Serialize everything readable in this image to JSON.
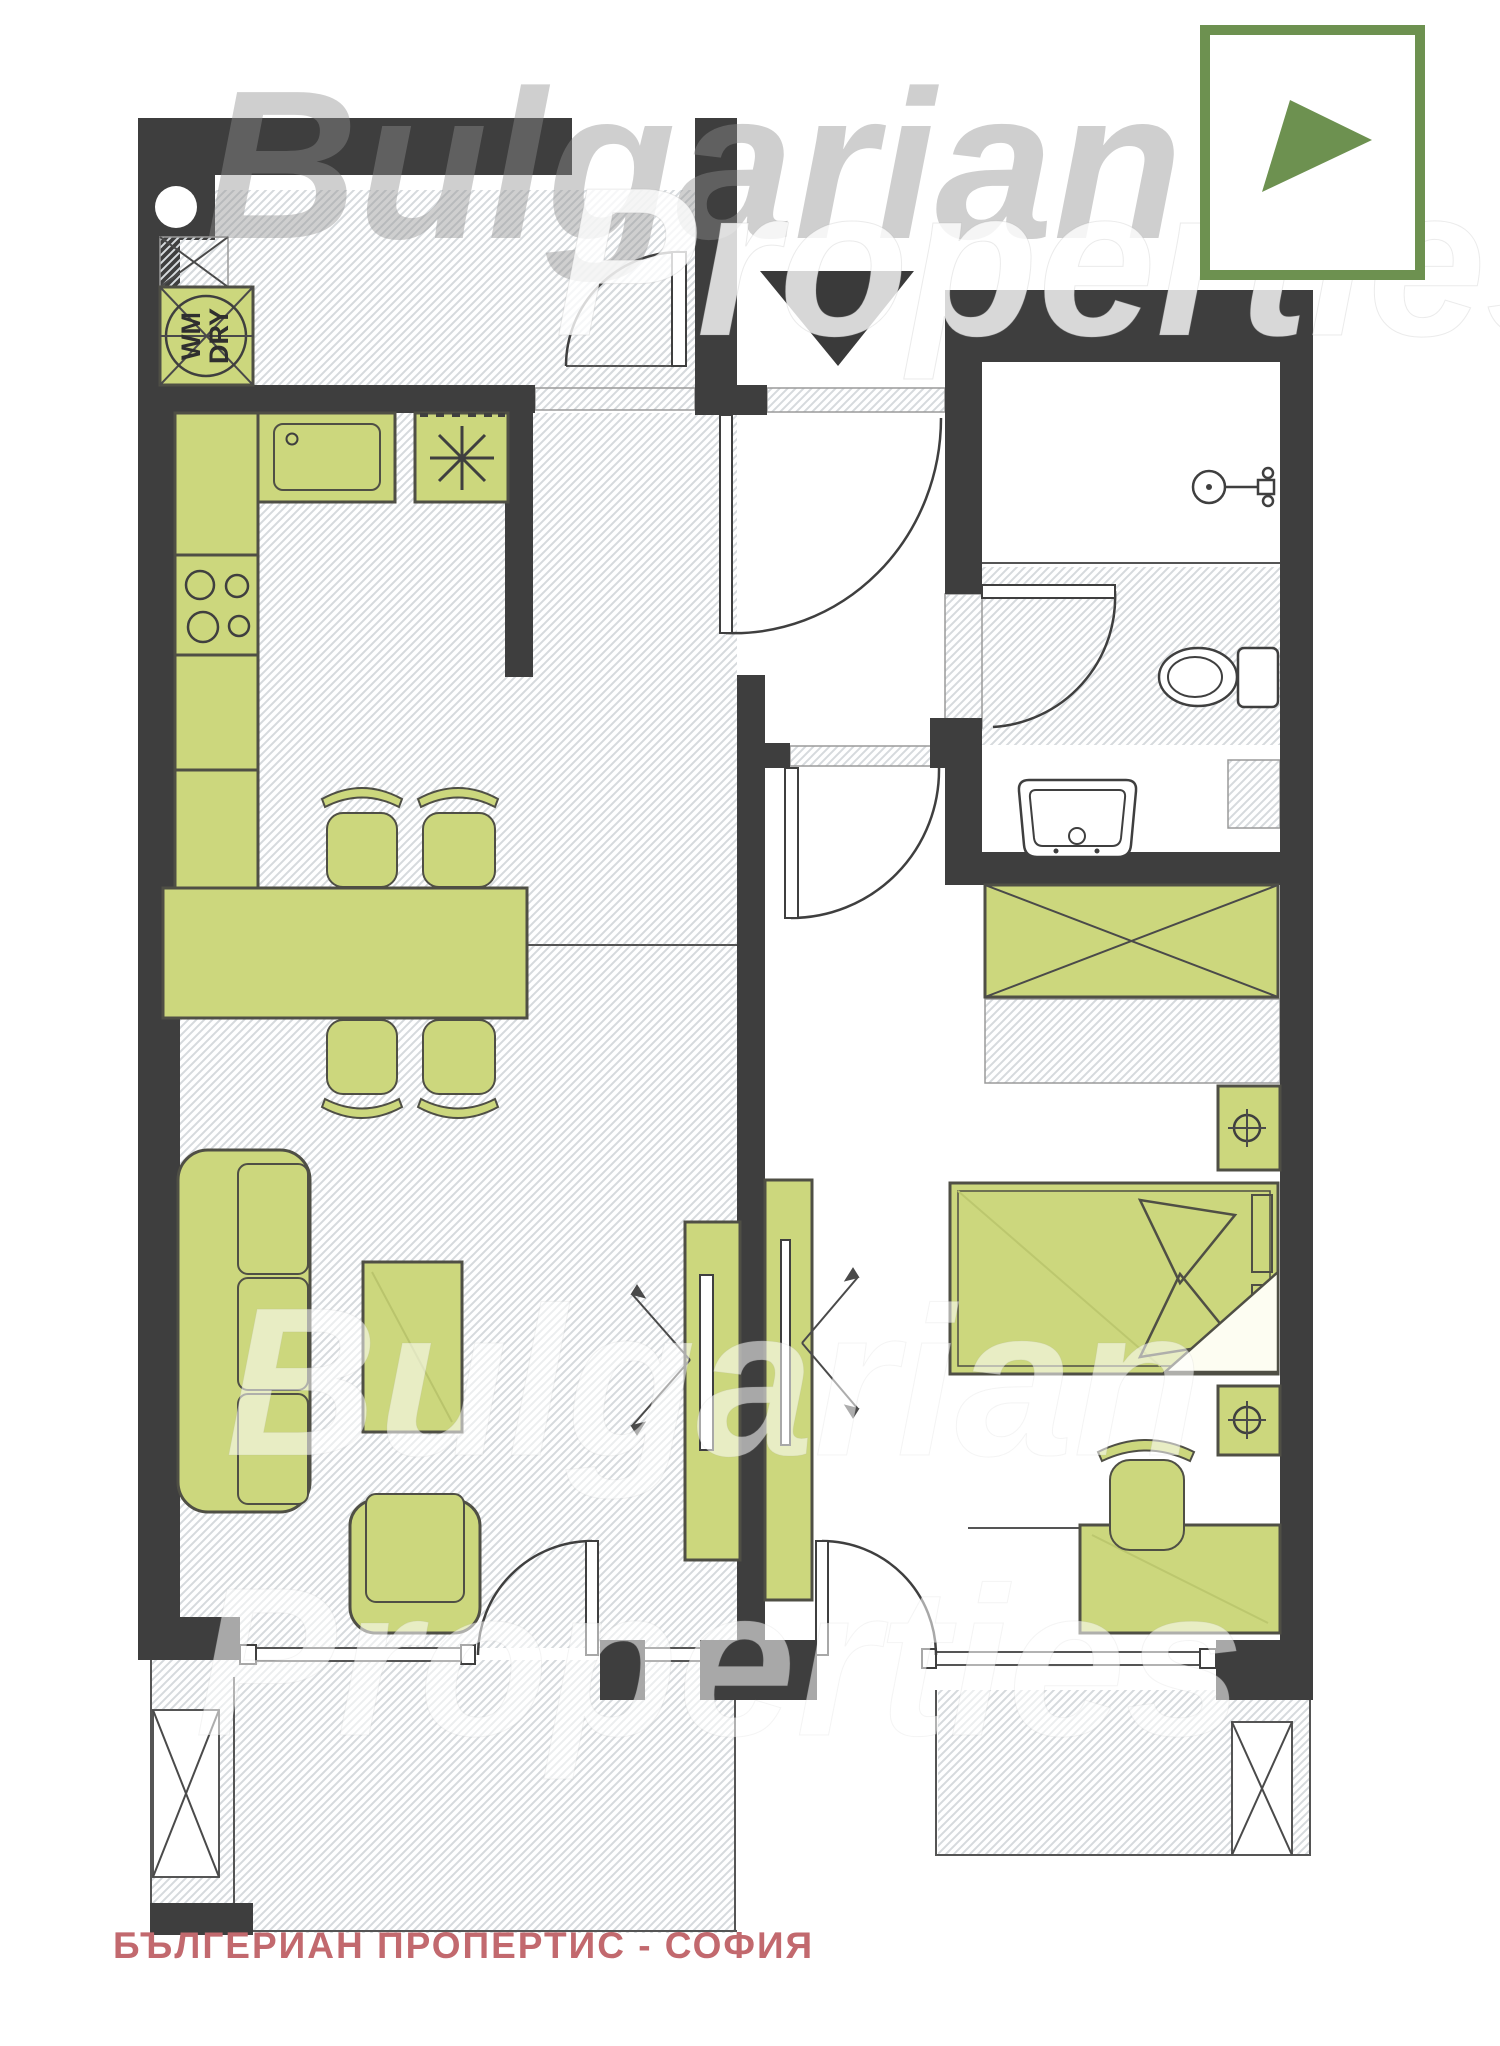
{
  "branding": {
    "caption": "БЪЛГЕРИАН ПРОПЕРТИС - СОФИЯ",
    "watermark_top_line1": "Bulgarian",
    "watermark_top_line2": "Properties",
    "watermark_bottom_line1": "Bulgarian",
    "watermark_bottom_line2": "Properties"
  },
  "labels": {
    "washer_line1": "WM",
    "washer_line2": "DRY"
  },
  "icons": {
    "logo": "green-square-with-arrow-triangle",
    "north_arrow": "solid-down-triangle",
    "stove": "asterisk-burner",
    "lamp": "crosshair-circle",
    "shower": "shower-head"
  },
  "colors": {
    "wall": "#3e3e3e",
    "furniture": "#ccd77d",
    "furnitureStroke": "#4f4f45",
    "hatch": "#d6dadd",
    "logoGreen": "#6d9150",
    "captionRed": "#c2696e"
  }
}
